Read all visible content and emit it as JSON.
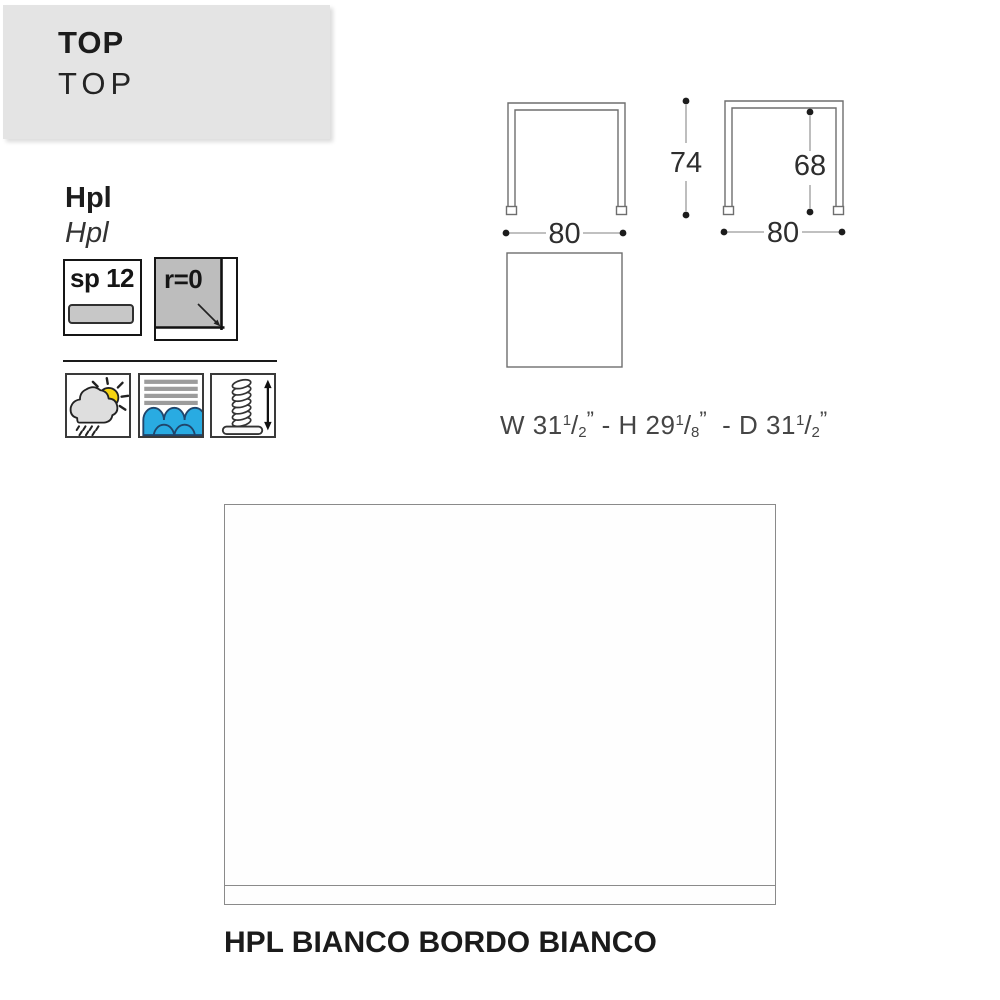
{
  "header": {
    "title": "TOP",
    "subtitle": "TOP"
  },
  "material": {
    "title": "Hpl",
    "subtitle": "Hpl"
  },
  "specs": {
    "thickness": "sp 12",
    "edge_radius": "r=0"
  },
  "feature_icons": [
    {
      "icon": "sun-cloud-rain-icon",
      "meaning": "weather-resistant"
    },
    {
      "icon": "water-waves-icon",
      "meaning": "water-resistant"
    },
    {
      "icon": "adjustable-foot-icon",
      "meaning": "height-adjustable-feet"
    }
  ],
  "drawings": {
    "front_view": {
      "width": "80",
      "height": "74"
    },
    "side_view": {
      "width": "80",
      "clearance_height": "68"
    }
  },
  "size_note": {
    "parts": [
      {
        "pre": "W 31",
        "num": "1",
        "den": "2"
      },
      {
        "pre": " - H 29",
        "num": "1",
        "den": "8"
      },
      {
        "pre": "  - D 31",
        "num": "1",
        "den": "2"
      }
    ],
    "slash": "/",
    "quote": "”"
  },
  "finish_label": "HPL BIANCO BORDO BIANCO",
  "colors": {
    "banner_bg": "#e4e4e4",
    "sun_yellow": "#f6d411",
    "water_blue": "#29abe2",
    "corner_gray_fill": "#bdbdbd",
    "drawing_line_gray": "#6e6e6e",
    "text_dark": "#1c1c1c"
  }
}
